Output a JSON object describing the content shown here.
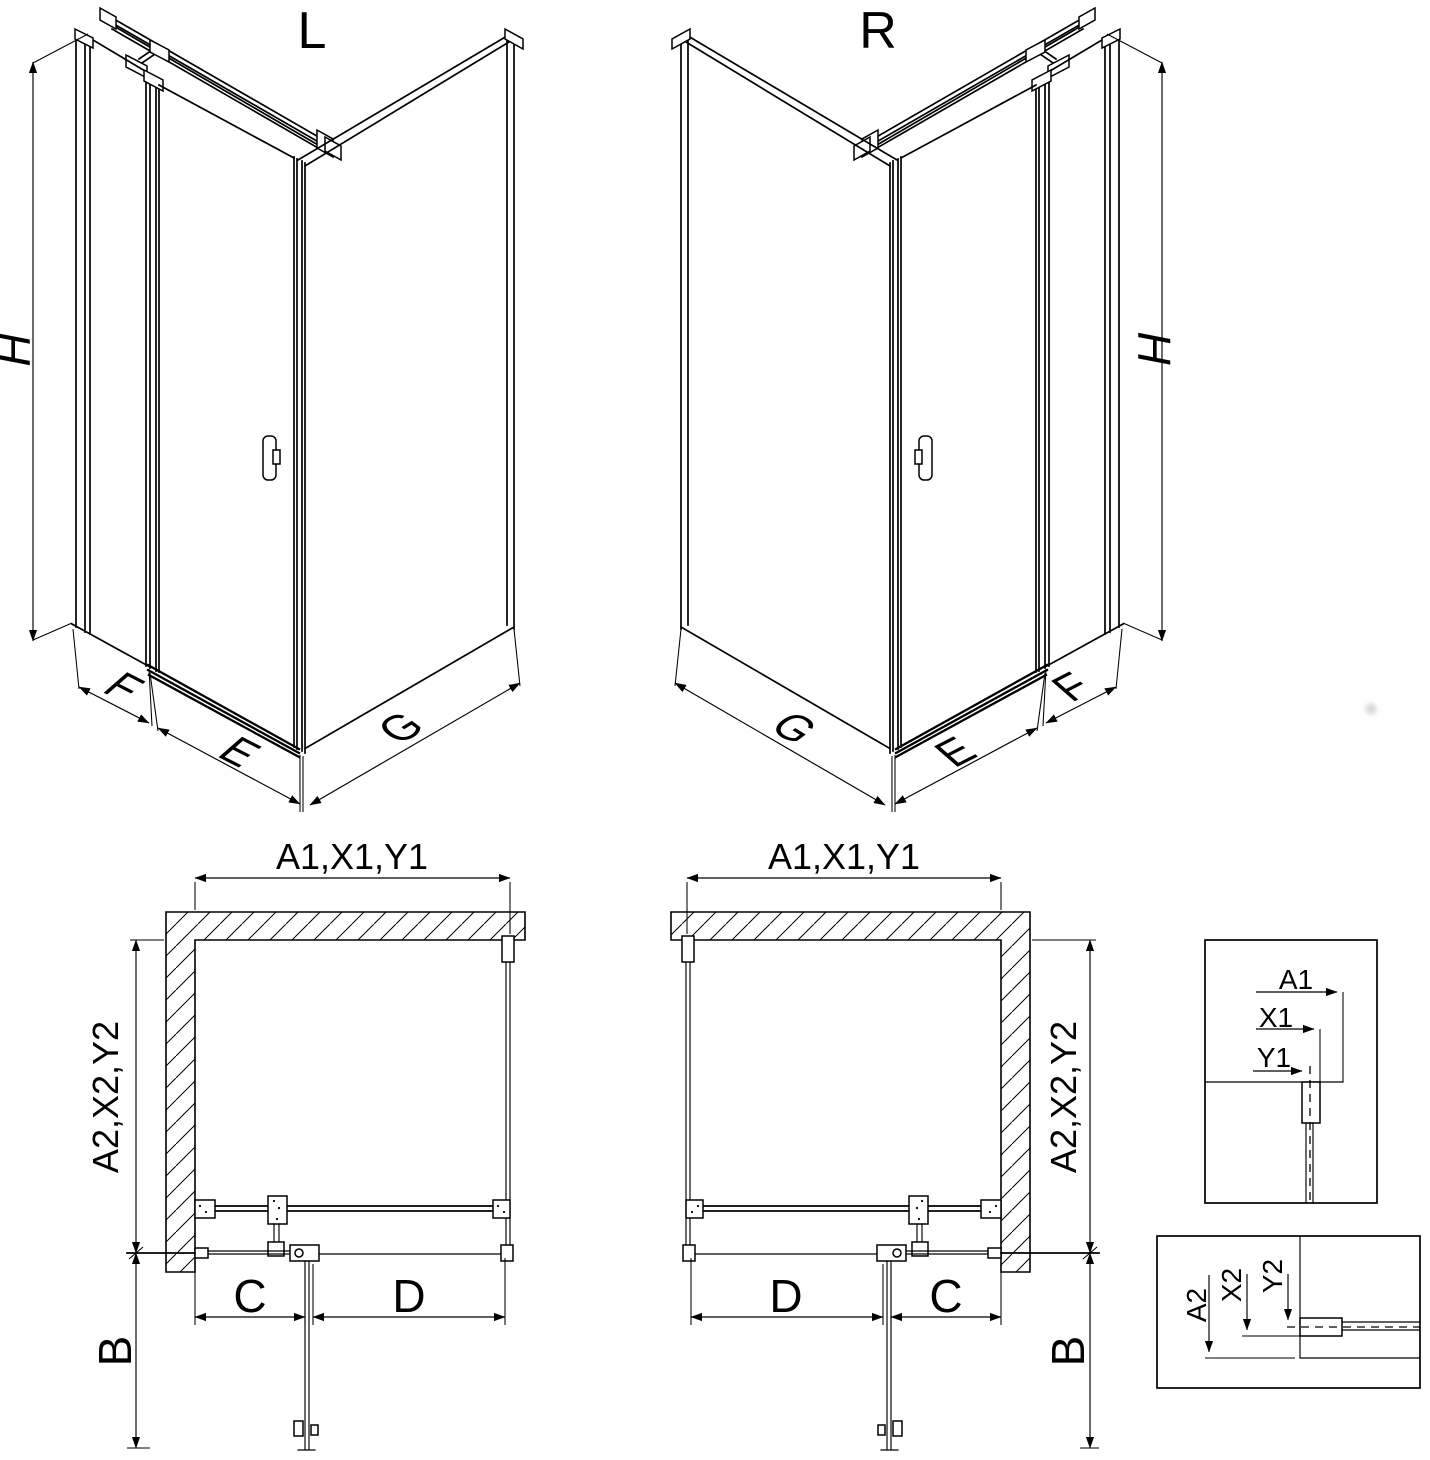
{
  "page": {
    "background": "#ffffff",
    "line_color": "#000000",
    "title": "Shower enclosure installation diagram"
  },
  "iso_left": {
    "title": "L",
    "dim_height": "H",
    "dim_side_panel": "F",
    "dim_door": "E",
    "dim_fixed_wall": "G"
  },
  "iso_right": {
    "title": "R",
    "dim_height": "H",
    "dim_side_panel": "F",
    "dim_door": "E",
    "dim_fixed_wall": "G"
  },
  "plan_left": {
    "dim_width": "A1,X1,Y1",
    "dim_depth": "A2,X2,Y2",
    "dim_fixed_segment": "C",
    "dim_door_segment": "D",
    "dim_door_swing": "B"
  },
  "plan_right": {
    "dim_width": "A1,X1,Y1",
    "dim_depth": "A2,X2,Y2",
    "dim_fixed_segment": "C",
    "dim_door_segment": "D",
    "dim_door_swing": "B"
  },
  "detail_width": {
    "dim_a": "A1",
    "dim_x": "X1",
    "dim_y": "Y1"
  },
  "detail_depth": {
    "dim_a": "A2",
    "dim_x": "X2",
    "dim_y": "Y2"
  }
}
